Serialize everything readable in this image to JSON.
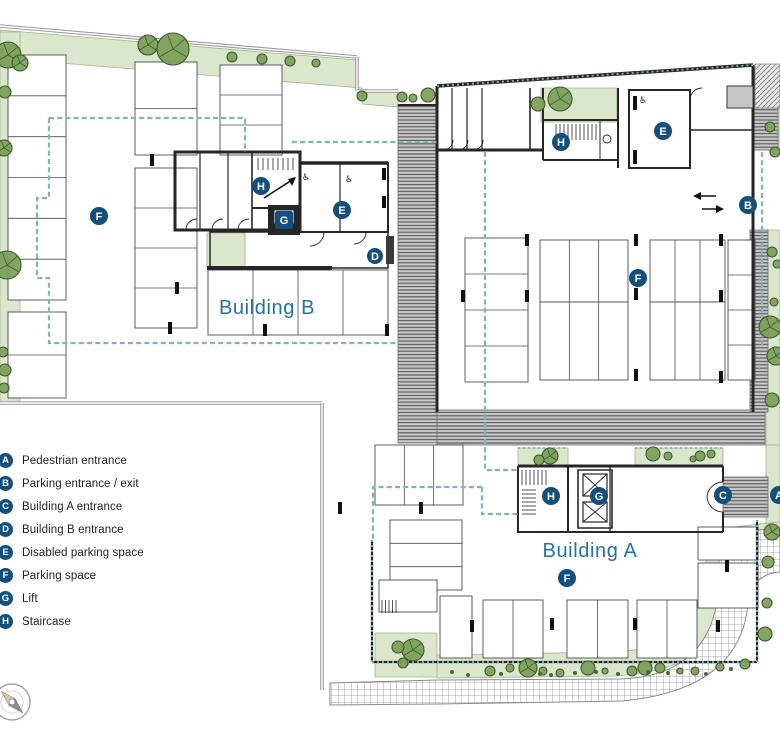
{
  "title": "Site plan with Building A and Building B parking level",
  "colors": {
    "badge": "#124e7e",
    "label_blue": "#2273a8",
    "green": "#dbe7cd",
    "green_edge": "#9fb38c",
    "tree_fill": "#7ca15b",
    "tree_stroke": "#3d5a2c",
    "bush": "#4c6836",
    "teal": "#7fb5b5",
    "wall_gray": "#9b9b9b",
    "dark": "#262626",
    "stall_stroke": "#4d4d4d",
    "stripe_bg": "#c9c9c9",
    "stripe_line": "#5c5c5c",
    "grid_line": "#8f8f8f",
    "concrete": "#c6c6c6",
    "compass_tan": "#d9c7a0",
    "compass_gray": "#8b8b8b"
  },
  "legend": {
    "items": [
      {
        "key": "A",
        "label": "Pedestrian entrance"
      },
      {
        "key": "B",
        "label": "Parking entrance / exit"
      },
      {
        "key": "C",
        "label": "Building A entrance"
      },
      {
        "key": "D",
        "label": "Building B entrance"
      },
      {
        "key": "E",
        "label": "Disabled parking space"
      },
      {
        "key": "F",
        "label": "Parking space"
      },
      {
        "key": "G",
        "label": "Lift"
      },
      {
        "key": "H",
        "label": "Staircase"
      }
    ]
  },
  "plan": {
    "width": 780,
    "height": 733,
    "labels": [
      {
        "text": "Building B",
        "x": 267,
        "y": 314,
        "size": 20
      },
      {
        "text": "Building A",
        "x": 590,
        "y": 557,
        "size": 20
      }
    ],
    "badges": [
      {
        "key": "F",
        "x": 99,
        "y": 216
      },
      {
        "key": "H",
        "x": 261,
        "y": 186
      },
      {
        "key": "G",
        "x": 284,
        "y": 220,
        "shape": "sq"
      },
      {
        "key": "E",
        "x": 342,
        "y": 210
      },
      {
        "key": "D",
        "x": 375,
        "y": 256,
        "r": 8
      },
      {
        "key": "H",
        "x": 561,
        "y": 142
      },
      {
        "key": "E",
        "x": 663,
        "y": 131
      },
      {
        "key": "B",
        "x": 748,
        "y": 205
      },
      {
        "key": "F",
        "x": 638,
        "y": 278
      },
      {
        "key": "H",
        "x": 551,
        "y": 496
      },
      {
        "key": "G",
        "x": 599,
        "y": 496
      },
      {
        "key": "C",
        "x": 723,
        "y": 495
      },
      {
        "key": "A",
        "x": 779,
        "y": 495
      },
      {
        "key": "F",
        "x": 567,
        "y": 578
      }
    ],
    "greens": [
      {
        "d": "M0,30 L357,60 L357,91 L398,91 L398,107 L362,104 L362,88 L0,58 Z"
      },
      {
        "d": "M0,32 H20 V402 H0 Z"
      },
      {
        "d": "M207,233 H245 V268 H207 Z"
      },
      {
        "d": "M541,88 H617 V122 H541 Z"
      },
      {
        "d": "M755,108 H780 V150 H755 Z"
      },
      {
        "d": "M766,230 H780 V445 H766 Z"
      },
      {
        "d": "M766,445 H780 V525 H766 Z"
      },
      {
        "d": "M518,448 H568 V466 H518 Z"
      },
      {
        "d": "M635,448 H723 V466 H635 Z"
      },
      {
        "d": "M375,633 H437 V677 H375 Z"
      },
      {
        "d": "M437,655 L615,652 Q700,648 706,566 L706,530 L760,524 L780,522 L780,545 L764,546 Q736,548 734,590 Q728,668 616,676 L437,678 Z"
      }
    ],
    "stripes": [
      {
        "x": 398,
        "y": 105,
        "w": 39,
        "h": 338
      },
      {
        "x": 437,
        "y": 410,
        "w": 328,
        "h": 35
      },
      {
        "x": 753,
        "y": 66,
        "w": 25,
        "h": 84
      },
      {
        "x": 750,
        "y": 230,
        "w": 18,
        "h": 182
      },
      {
        "x": 723,
        "y": 477,
        "w": 45,
        "h": 40
      }
    ],
    "diag": [
      {
        "x": 755,
        "y": 64,
        "w": 25,
        "h": 44
      }
    ],
    "road": {
      "d": "M330,683 L437,680 L620,679 Q714,676 719,584 L719,534 L780,528 L780,572 Q752,574 748,604 Q740,690 622,701 L437,704 L330,705 Z"
    },
    "gray_walls": [
      {
        "d": "M0,26 L357,57"
      },
      {
        "d": "M357,57 V91"
      },
      {
        "d": "M357,91 H398"
      },
      {
        "d": "M0,403 H322"
      },
      {
        "d": "M322,403 V690"
      }
    ],
    "stalls": [
      {
        "x": 8,
        "y": 55,
        "w": 58,
        "h": 245,
        "cols": 1,
        "rows": 6
      },
      {
        "x": 8,
        "y": 312,
        "w": 58,
        "h": 86,
        "cols": 1,
        "rows": 2
      },
      {
        "x": 135,
        "y": 62,
        "w": 62,
        "h": 93,
        "cols": 1,
        "rows": 2
      },
      {
        "x": 135,
        "y": 168,
        "w": 62,
        "h": 160,
        "cols": 1,
        "rows": 4
      },
      {
        "x": 220,
        "y": 65,
        "w": 62,
        "h": 90,
        "cols": 1,
        "rows": 3
      },
      {
        "x": 208,
        "y": 270,
        "w": 180,
        "h": 65,
        "cols": 4,
        "rows": 1
      },
      {
        "x": 465,
        "y": 238,
        "w": 63,
        "h": 144,
        "cols": 1,
        "rows": 4
      },
      {
        "x": 540,
        "y": 240,
        "w": 88,
        "h": 62,
        "cols": 3,
        "rows": 1
      },
      {
        "x": 540,
        "y": 302,
        "w": 88,
        "h": 78,
        "cols": 3,
        "rows": 1
      },
      {
        "x": 650,
        "y": 240,
        "w": 75,
        "h": 62,
        "cols": 3,
        "rows": 1
      },
      {
        "x": 650,
        "y": 302,
        "w": 75,
        "h": 78,
        "cols": 3,
        "rows": 1
      },
      {
        "x": 728,
        "y": 240,
        "w": 27,
        "h": 140,
        "cols": 1,
        "rows": 4
      },
      {
        "x": 375,
        "y": 445,
        "w": 88,
        "h": 60,
        "cols": 3,
        "rows": 1
      },
      {
        "x": 390,
        "y": 520,
        "w": 72,
        "h": 70,
        "cols": 1,
        "rows": 3
      },
      {
        "x": 379,
        "y": 580,
        "w": 58,
        "h": 32,
        "cols": 1,
        "rows": 1
      },
      {
        "x": 440,
        "y": 596,
        "w": 32,
        "h": 62,
        "cols": 1,
        "rows": 1
      },
      {
        "x": 483,
        "y": 600,
        "w": 60,
        "h": 58,
        "cols": 2,
        "rows": 1
      },
      {
        "x": 567,
        "y": 600,
        "w": 61,
        "h": 58,
        "cols": 2,
        "rows": 1
      },
      {
        "x": 637,
        "y": 600,
        "w": 60,
        "h": 58,
        "cols": 2,
        "rows": 1
      },
      {
        "x": 698,
        "y": 527,
        "w": 60,
        "h": 33,
        "cols": 1,
        "rows": 1
      },
      {
        "x": 698,
        "y": 563,
        "w": 60,
        "h": 45,
        "cols": 1,
        "rows": 1
      }
    ],
    "walls": [
      {
        "d": "M437,86 L753,65",
        "w": 3.5
      },
      {
        "d": "M437,86 V412",
        "w": 3
      },
      {
        "d": "M753,65 V412",
        "w": 3
      },
      {
        "d": "M437,150 H543",
        "w": 3
      },
      {
        "d": "M452,88 V150",
        "w": 1.2
      },
      {
        "d": "M467,88 V150",
        "w": 1.2
      },
      {
        "d": "M482,88 V150",
        "w": 1.2
      },
      {
        "d": "M530,88 V150",
        "w": 1.6
      },
      {
        "d": "M443,150 a10,10 0 0 0 10,-10",
        "w": 0.9
      },
      {
        "d": "M458,150 a10,10 0 0 0 10,-10",
        "w": 0.9
      },
      {
        "d": "M473,150 a10,10 0 0 0 10,-10",
        "w": 0.9
      },
      {
        "d": "M543,88 V160",
        "w": 2
      },
      {
        "d": "M543,120 H618",
        "w": 2
      },
      {
        "d": "M618,88 V168",
        "w": 2
      },
      {
        "d": "M543,160 H618",
        "w": 2
      },
      {
        "d": "M600,120 V160",
        "w": 1
      },
      {
        "d": "M629,90 H690 V168 H629 Z",
        "w": 2
      },
      {
        "d": "M690,130 H753",
        "w": 1.5
      },
      {
        "d": "M690,100 a12,12 0 0 1 12,-12",
        "w": 0.9
      },
      {
        "d": "M398,105 H437",
        "w": 2
      },
      {
        "d": "M175,152 H300 V230 H175 Z",
        "w": 3
      },
      {
        "d": "M200,152 V230",
        "w": 1.2
      },
      {
        "d": "M228,152 V230",
        "w": 1.2
      },
      {
        "d": "M252,152 V230",
        "w": 1.6
      },
      {
        "d": "M186,230 a11,11 0 0 1 11,-11",
        "w": 0.9
      },
      {
        "d": "M212,230 a11,11 0 0 1 11,-11",
        "w": 0.9
      },
      {
        "d": "M238,230 a11,11 0 0 1 11,-11",
        "w": 0.9
      },
      {
        "d": "M252,152 H300 V208 H252",
        "w": 2
      },
      {
        "d": "M300,163 H388 V232 H300 Z",
        "w": 2
      },
      {
        "d": "M300,163 H388",
        "w": 3.5
      },
      {
        "d": "M340,163 V232",
        "w": 1.2
      },
      {
        "d": "M210,232 H388 V268 H210 Z",
        "w": 1.5
      },
      {
        "d": "M207,268 H332",
        "w": 4
      },
      {
        "d": "M324,232 a14,14 0 0 1 -14,14",
        "w": 0.9
      },
      {
        "d": "M366,232 a12,12 0 0 1 -12,12",
        "w": 0.9
      },
      {
        "d": "M518,466 H723",
        "w": 3
      },
      {
        "d": "M518,466 V532 H723",
        "w": 2
      },
      {
        "d": "M723,466 V482",
        "w": 2
      },
      {
        "d": "M723,512 V532",
        "w": 2
      },
      {
        "d": "M568,466 V532",
        "w": 2
      },
      {
        "d": "M610,466 V532",
        "w": 1.3
      },
      {
        "d": "M578,470 H612 V528 H578 Z",
        "w": 1.6
      },
      {
        "d": "M723,482 a16,16 0 0 0 -16,16",
        "w": 0.9
      },
      {
        "d": "M723,512 a16,16 0 0 1 -16,-16",
        "w": 0.9
      },
      {
        "d": "M372,540 V662",
        "w": 2.2
      },
      {
        "d": "M372,662 H757",
        "w": 2.2
      },
      {
        "d": "M757,520 V662",
        "w": 2.2
      }
    ],
    "solids": [
      {
        "x": 727,
        "y": 86,
        "w": 26,
        "h": 22,
        "fill": "#c6c6c6",
        "stroke": "#3a3a3a"
      },
      {
        "x": 268,
        "y": 205,
        "w": 32,
        "h": 30,
        "fill": "#262626",
        "stroke": "none"
      },
      {
        "x": 274,
        "y": 210,
        "w": 20,
        "h": 14,
        "fill": "#ffffff",
        "stroke": "#262626"
      },
      {
        "x": 386,
        "y": 236,
        "w": 8,
        "h": 28,
        "fill": "#3a3a3a",
        "stroke": "none"
      },
      {
        "x": 633,
        "y": 96,
        "w": 4,
        "h": 14,
        "fill": "#111111",
        "stroke": "none"
      },
      {
        "x": 633,
        "y": 150,
        "w": 4,
        "h": 14,
        "fill": "#111111",
        "stroke": "none"
      },
      {
        "x": 382,
        "y": 168,
        "w": 4,
        "h": 12,
        "fill": "#111111",
        "stroke": "none"
      },
      {
        "x": 382,
        "y": 196,
        "w": 4,
        "h": 12,
        "fill": "#111111",
        "stroke": "none"
      }
    ],
    "lifts": [
      {
        "x": 583,
        "y": 474,
        "w": 24,
        "h": 22
      },
      {
        "x": 583,
        "y": 502,
        "w": 24,
        "h": 20
      }
    ],
    "ladders": [
      {
        "x": 556,
        "y": 124,
        "w": 44,
        "h": 16,
        "step": 4,
        "dir": "v"
      },
      {
        "x": 258,
        "y": 158,
        "w": 36,
        "h": 12,
        "step": 5,
        "dir": "v"
      },
      {
        "x": 522,
        "y": 470,
        "w": 24,
        "h": 15,
        "step": 4,
        "dir": "v"
      },
      {
        "x": 522,
        "y": 490,
        "w": 14,
        "h": 24,
        "step": 4,
        "dir": "h"
      },
      {
        "x": 382,
        "y": 600,
        "w": 15,
        "h": 13,
        "step": 3.5,
        "dir": "v"
      }
    ],
    "ticks": [
      [
        152,
        160
      ],
      [
        177,
        288
      ],
      [
        170,
        328
      ],
      [
        265,
        330
      ],
      [
        387,
        330
      ],
      [
        463,
        296
      ],
      [
        527,
        240
      ],
      [
        527,
        296
      ],
      [
        636,
        240
      ],
      [
        636,
        294
      ],
      [
        636,
        375
      ],
      [
        721,
        240
      ],
      [
        721,
        296
      ],
      [
        721,
        377
      ],
      [
        340,
        508
      ],
      [
        421,
        508
      ],
      [
        472,
        626
      ],
      [
        552,
        624
      ],
      [
        635,
        624
      ],
      [
        718,
        626
      ],
      [
        727,
        566
      ]
    ],
    "dashed": [
      {
        "d": "M49,118 H245 V152"
      },
      {
        "d": "M49,118 V198 H37 V278 H49 V343 H397"
      },
      {
        "d": "M292,142 H437"
      },
      {
        "d": "M485,152 V470 H518"
      },
      {
        "d": "M482,487 H373 V540"
      },
      {
        "d": "M482,487 V514 H518"
      },
      {
        "d": "M762,152 V348"
      }
    ],
    "dotted": [
      {
        "d": "M437,86 L753,65"
      },
      {
        "d": "M372,540 V662"
      },
      {
        "d": "M372,662 H757"
      },
      {
        "d": "M757,520 V662"
      },
      {
        "d": "M518,448 H568"
      },
      {
        "d": "M635,448 H723"
      }
    ],
    "trees": [
      [
        8,
        55,
        13
      ],
      [
        20,
        63,
        8
      ],
      [
        148,
        45,
        10
      ],
      [
        173,
        49,
        16
      ],
      [
        232,
        57,
        5
      ],
      [
        262,
        59,
        5
      ],
      [
        290,
        61,
        5
      ],
      [
        316,
        63,
        4
      ],
      [
        362,
        96,
        5
      ],
      [
        402,
        97,
        5
      ],
      [
        413,
        98,
        4
      ],
      [
        428,
        95,
        7
      ],
      [
        5,
        92,
        6
      ],
      [
        4,
        148,
        8
      ],
      [
        7,
        265,
        14
      ],
      [
        3,
        352,
        5
      ],
      [
        5,
        370,
        6
      ],
      [
        4,
        388,
        5
      ],
      [
        560,
        99,
        12
      ],
      [
        538,
        104,
        7
      ],
      [
        770,
        127,
        5
      ],
      [
        775,
        152,
        5
      ],
      [
        772,
        252,
        5
      ],
      [
        777,
        264,
        4
      ],
      [
        774,
        302,
        4
      ],
      [
        770,
        327,
        11
      ],
      [
        776,
        356,
        9
      ],
      [
        772,
        400,
        7
      ],
      [
        550,
        456,
        8
      ],
      [
        539,
        460,
        5
      ],
      [
        653,
        454,
        7
      ],
      [
        668,
        456,
        4
      ],
      [
        700,
        456,
        5
      ],
      [
        711,
        454,
        4
      ],
      [
        693,
        459,
        3
      ],
      [
        413,
        650,
        11
      ],
      [
        398,
        647,
        6
      ],
      [
        403,
        663,
        5
      ],
      [
        490,
        671,
        5
      ],
      [
        510,
        668,
        4
      ],
      [
        528,
        668,
        9
      ],
      [
        543,
        671,
        4
      ],
      [
        560,
        673,
        4
      ],
      [
        588,
        668,
        7
      ],
      [
        605,
        671,
        3
      ],
      [
        632,
        671,
        5
      ],
      [
        645,
        668,
        7
      ],
      [
        660,
        668,
        5
      ],
      [
        680,
        671,
        3
      ],
      [
        695,
        671,
        4
      ],
      [
        720,
        667,
        4
      ],
      [
        745,
        664,
        5
      ],
      [
        765,
        634,
        7
      ],
      [
        767,
        603,
        5
      ],
      [
        768,
        562,
        6
      ],
      [
        772,
        532,
        8
      ]
    ],
    "dots": [
      [
        452,
        672
      ],
      [
        468,
        675
      ],
      [
        501,
        674
      ],
      [
        540,
        674
      ],
      [
        551,
        675
      ],
      [
        575,
        673
      ],
      [
        596,
        672
      ],
      [
        618,
        674
      ],
      [
        648,
        672
      ],
      [
        668,
        673
      ],
      [
        706,
        674
      ],
      [
        731,
        669
      ]
    ],
    "icons": [
      {
        "glyph": "♿",
        "x": 306,
        "y": 180
      },
      {
        "glyph": "♿",
        "x": 349,
        "y": 182
      },
      {
        "glyph": "♿",
        "x": 643,
        "y": 103
      }
    ],
    "rings": [
      [
        607,
        139,
        4
      ]
    ],
    "arrows": [
      {
        "line": [
          698,
          196,
          716,
          196
        ],
        "head": [
          693,
          196,
          701,
          192,
          701,
          200
        ]
      },
      {
        "line": [
          702,
          209,
          719,
          209
        ],
        "head": [
          724,
          209,
          716,
          205,
          716,
          213
        ]
      },
      {
        "line": [
          264,
          198,
          292,
          180
        ],
        "head": [
          296,
          177,
          288,
          179,
          292,
          186
        ]
      }
    ],
    "compass": {
      "x": 12,
      "y": 702,
      "r": 18
    }
  }
}
